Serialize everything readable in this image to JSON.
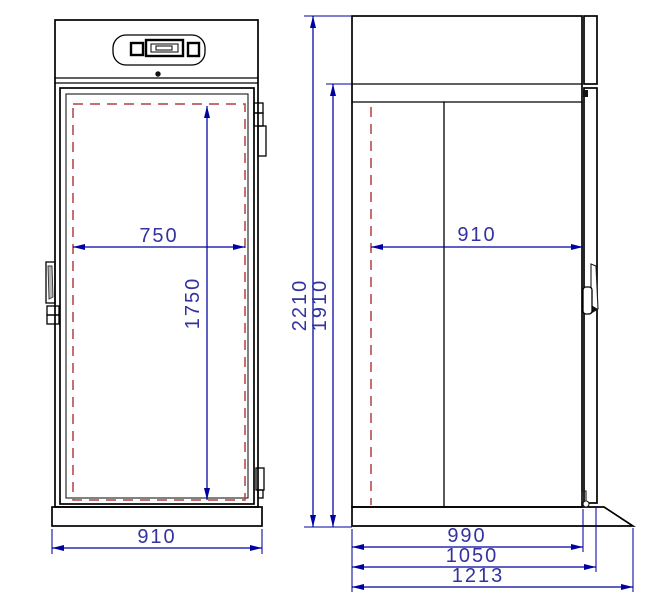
{
  "drawing": {
    "description": "Dimensioned two-view technical drawing of a roll-in refrigerator cabinet: front view (left) and side view (right).",
    "colors": {
      "outline": "#000000",
      "dimension_blue": "#0000a0",
      "dim_text_blue": "#3232a0",
      "clearance_red": "#b04040",
      "handle_gray": "#b5b5b5",
      "background": "#ffffff"
    },
    "front_view": {
      "dims": {
        "interior_width": "750",
        "interior_height": "1750",
        "overall_width": "910"
      }
    },
    "side_view": {
      "dims": {
        "overall_height": "2210",
        "door_opening_height": "1910",
        "interior_depth": "910",
        "body_depth": "990",
        "depth_with_door": "1050",
        "overall_depth": "1213"
      }
    }
  }
}
